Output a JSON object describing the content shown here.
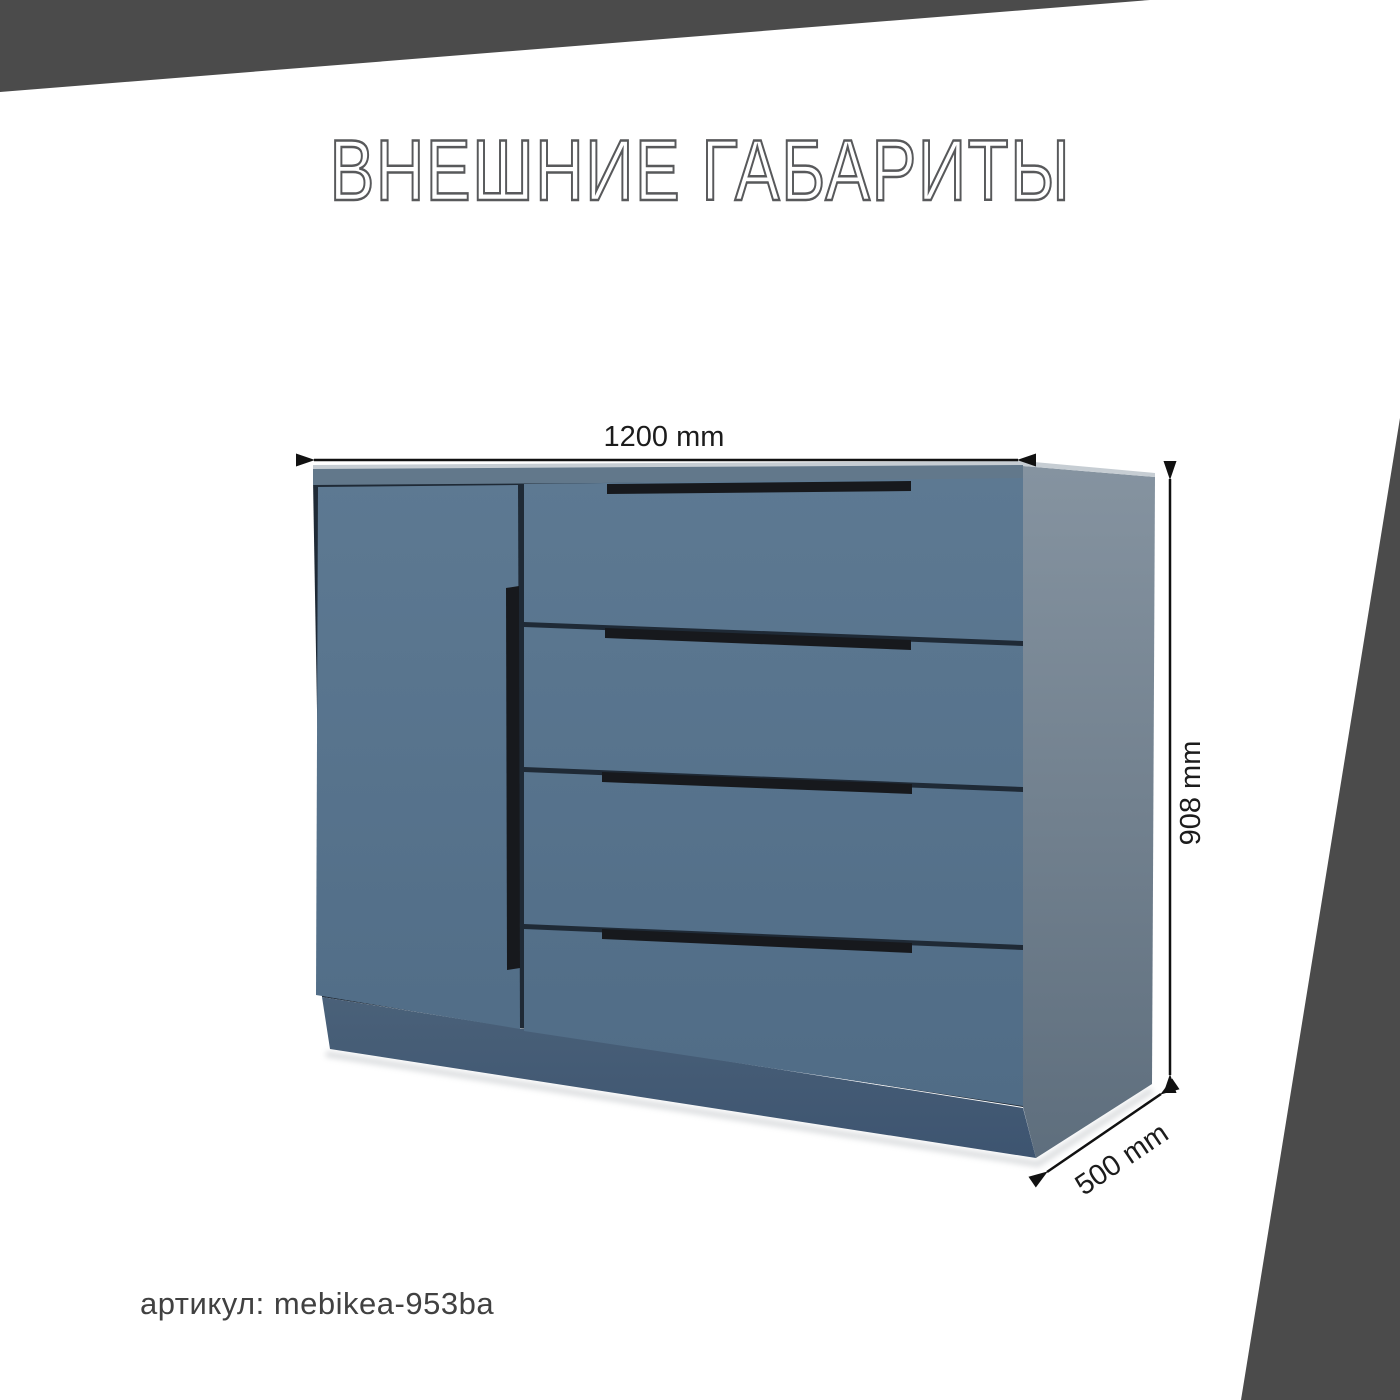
{
  "title": {
    "text": "ВНЕШНИЕ ГАБАРИТЫ"
  },
  "sku": {
    "label": "артикул: mebikea-953ba"
  },
  "dimensions": {
    "width": {
      "label": "1200 mm",
      "value_mm": 1200
    },
    "height": {
      "label": "908 mm",
      "value_mm": 908
    },
    "depth": {
      "label": "500 mm",
      "value_mm": 500
    }
  },
  "product": {
    "kind": "chest-of-drawers with door and 4 drawers",
    "colors": {
      "front_blue": "#5b7892",
      "front_blue_dark": "#506c86",
      "side_gray_top": "#8593a0",
      "side_gray_bottom": "#5e6e7d",
      "top_edge_strip": "#62788b",
      "top_highlight": "#c6cdd3",
      "plinth": "#455e76",
      "handle_black": "#17191d",
      "carcass_gap": "#1f2a36",
      "corner_decal": "#4b4b4b",
      "dimension_line": "#111111"
    }
  }
}
